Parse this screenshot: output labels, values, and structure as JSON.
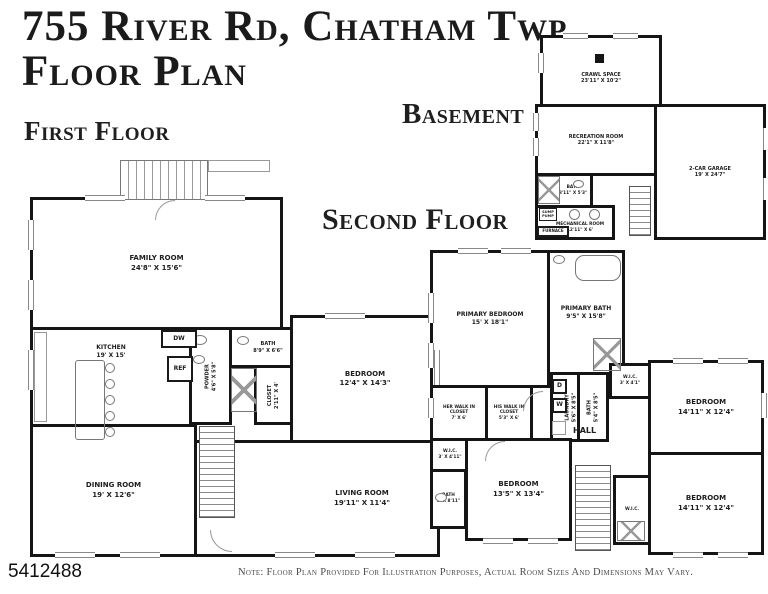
{
  "header": {
    "title_line1": "755 River Rd, Chatham Twp",
    "title_line2": "Floor Plan"
  },
  "sections": {
    "first_floor_label": "First Floor",
    "basement_label": "Basement",
    "second_floor_label": "Second Floor"
  },
  "first_floor": {
    "family_room": {
      "name": "FAMILY ROOM",
      "dims": "24'8\" X 15'6\""
    },
    "kitchen": {
      "name": "KITCHEN",
      "dims": "19' X 15'"
    },
    "dining_room": {
      "name": "DINING ROOM",
      "dims": "19' X 12'6\""
    },
    "living_room": {
      "name": "LIVING ROOM",
      "dims": "19'11\" X 11'4\""
    },
    "bedroom": {
      "name": "BEDROOM",
      "dims": "12'4\" X 14'3\""
    },
    "powder": {
      "name": "POWDER",
      "dims": "4'6\" X 5'8\""
    },
    "bath": {
      "name": "BATH",
      "dims": "8'9\" X 6'6\""
    },
    "closet": {
      "name": "CLOSET",
      "dims": "2'11\" X 4'"
    },
    "appliances": {
      "dw": "DW",
      "ref": "REF"
    }
  },
  "basement": {
    "crawl_space": {
      "name": "CRAWL SPACE",
      "dims": "23'11\" X 10'2\""
    },
    "recreation_room": {
      "name": "RECREATION ROOM",
      "dims": "22'1\" X 11'8\""
    },
    "garage": {
      "name": "2-CAR GARAGE",
      "dims": "19' X 24'7\""
    },
    "bath": {
      "name": "BATH",
      "dims": "8'11\" X 5'3\""
    },
    "mechanical_room": {
      "name": "MECHANICAL ROOM",
      "dims": "12'11\" X 6'"
    },
    "furnace": "FURNACE",
    "sump_pump": "SUMP PUMP"
  },
  "second_floor": {
    "primary_bedroom": {
      "name": "PRIMARY BEDROOM",
      "dims": "15' X 18'1\""
    },
    "primary_bath": {
      "name": "PRIMARY BATH",
      "dims": "9'5\" X 15'8\""
    },
    "her_closet": {
      "name": "HER WALK IN CLOSET",
      "dims": "7' X 6'"
    },
    "his_closet": {
      "name": "HIS WALK IN CLOSET",
      "dims": "5'3\" X 6'"
    },
    "wic_left": {
      "name": "W.I.C.",
      "dims": "3' X 4'11\""
    },
    "laundry": {
      "name": "LAUNDRY",
      "dims": "5'6\" X 8'5\""
    },
    "bath_mid": {
      "name": "BATH",
      "dims": "5'4\" X 8'5\""
    },
    "wic_mid": {
      "name": "W.I.C.",
      "dims": "3' X 4'1\""
    },
    "bedroom_upper": {
      "name": "BEDROOM",
      "dims": "14'11\" X 12'4\""
    },
    "bedroom_mid": {
      "name": "BEDROOM",
      "dims": "13'5\" X 13'4\""
    },
    "bath_lower": {
      "name": "BATH",
      "dims": "5' X 8'11\""
    },
    "bedroom_lower": {
      "name": "BEDROOM",
      "dims": "14'11\" X 12'4\""
    },
    "wic_small": {
      "name": "W.I.C."
    },
    "hall": "HALL",
    "washer": "W",
    "dryer": "D"
  },
  "footer": {
    "listing_id": "5412488",
    "note": "Note: Floor Plan Provided For Illustration Purposes, Actual Room Sizes And Dimensions  May Vary."
  },
  "colors": {
    "wall": "#151515",
    "fixture_line": "#8a8a8a",
    "background": "#ffffff"
  }
}
